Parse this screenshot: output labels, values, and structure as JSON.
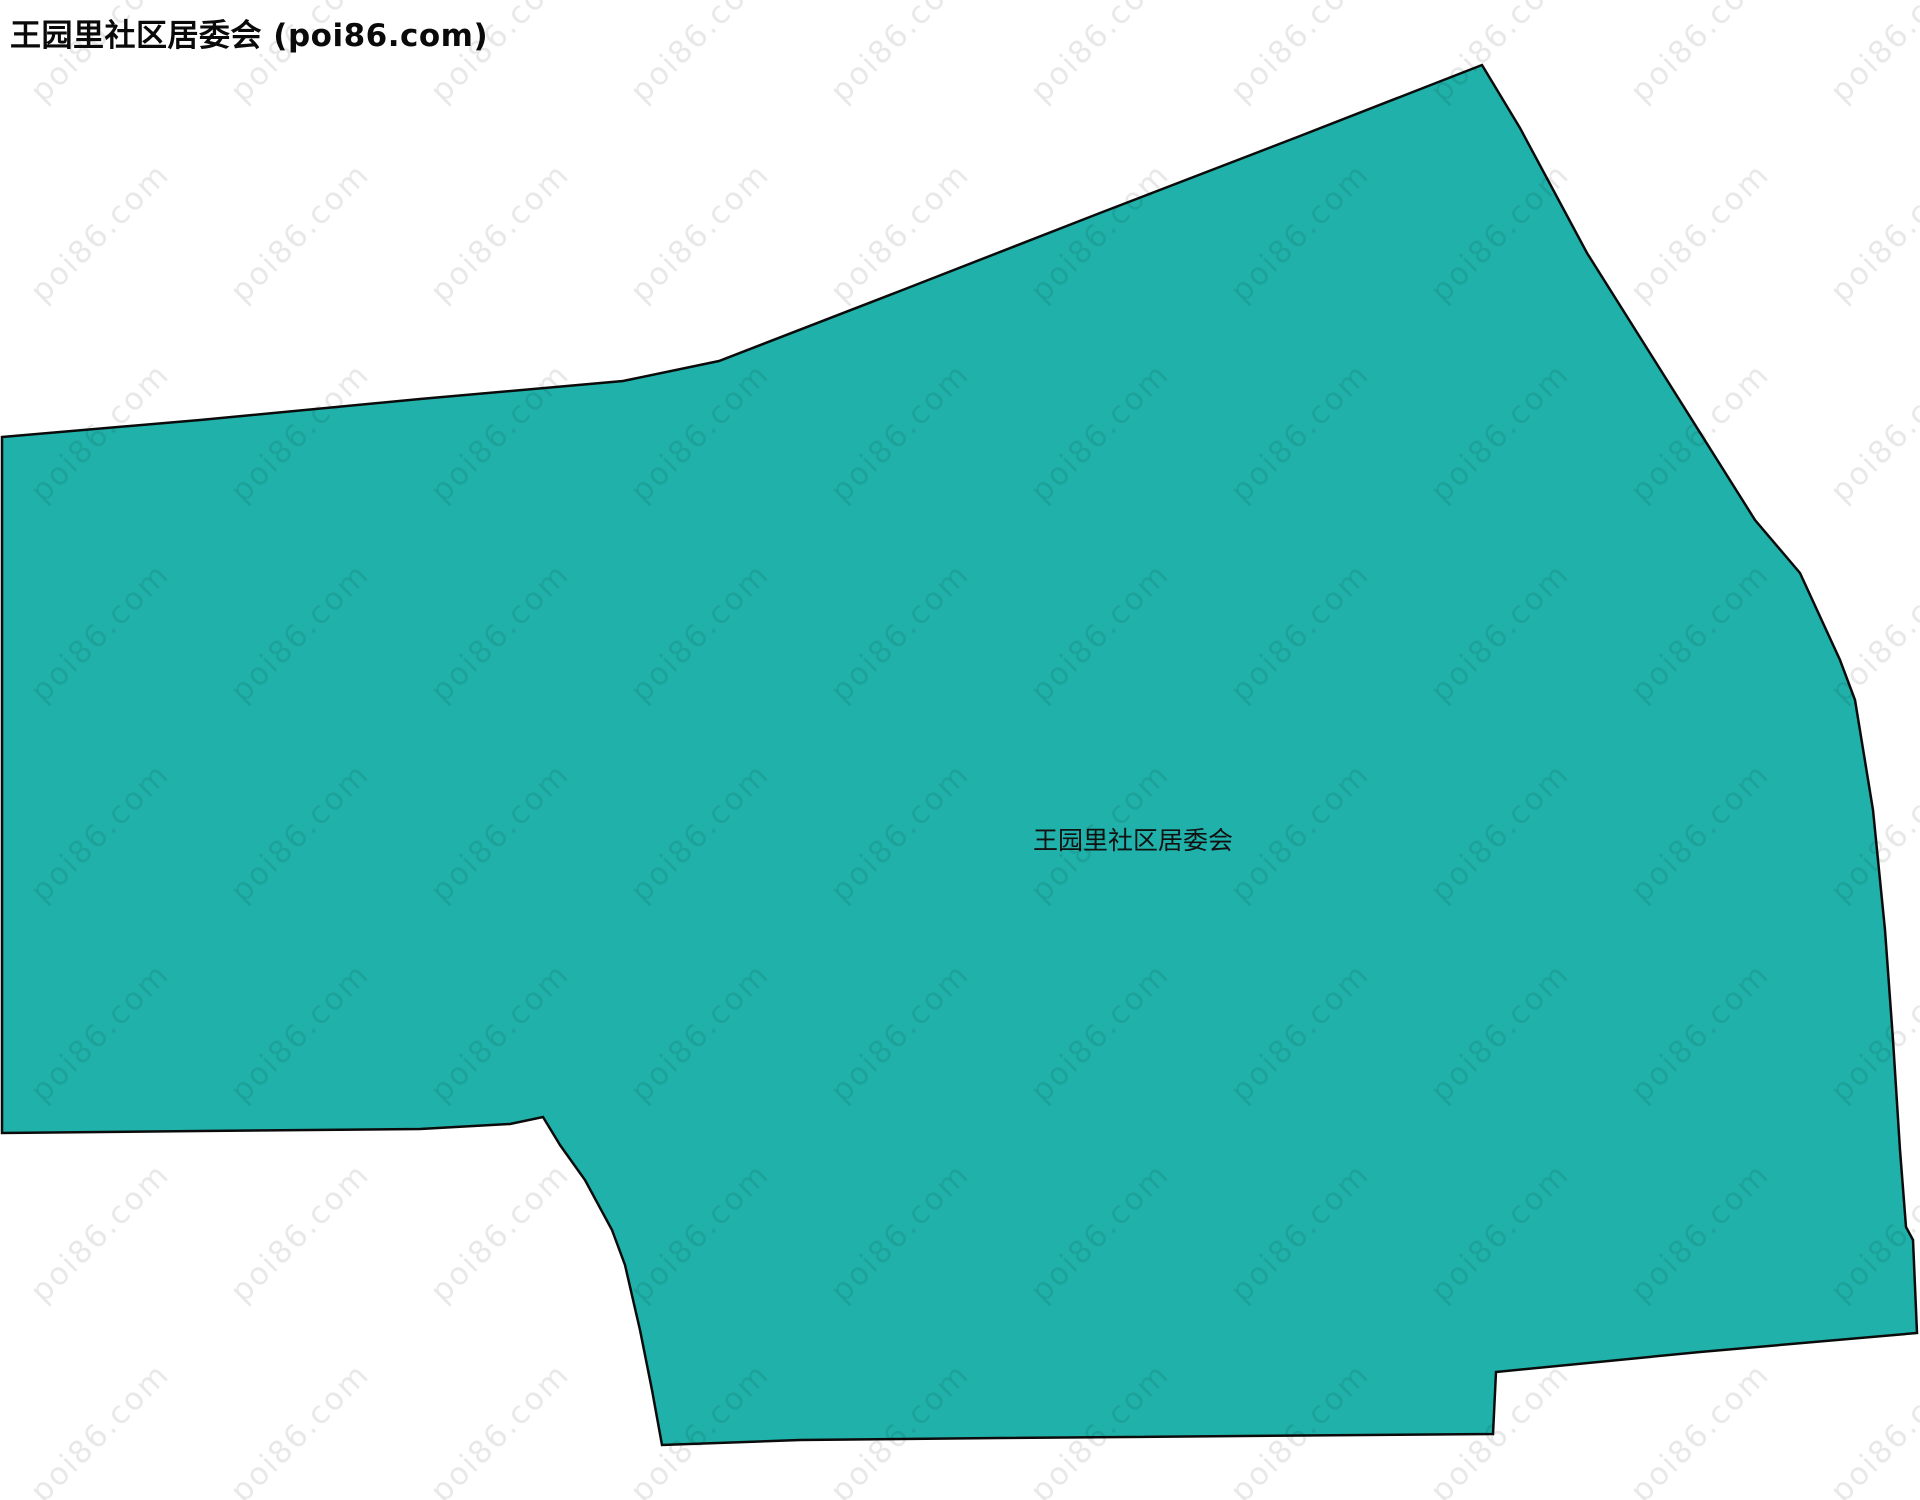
{
  "title": "王园里社区居委会 (poi86.com)",
  "region": {
    "label": "王园里社区居委会",
    "fill_color": "#20B2AA",
    "stroke_color": "#0b0b0b",
    "polygon_points": "2,437 200,420 420,399 623,381 719,361 900,291 1100,213 1300,136 1482,65 1520,128 1587,253 1755,520 1800,573 1840,660 1855,700 1873,810 1885,930 1893,1040 1900,1150 1906,1227 1913,1240 1917,1333 1700,1352 1496,1372 1493,1434 1000,1438 800,1440 662,1445 652,1390 640,1330 625,1265 612,1230 585,1180 560,1145 543,1117 510,1124 420,1129 200,1131 2,1133"
  },
  "watermark": {
    "text": "poi86.com",
    "color": "rgba(0,0,0,0.09)"
  }
}
